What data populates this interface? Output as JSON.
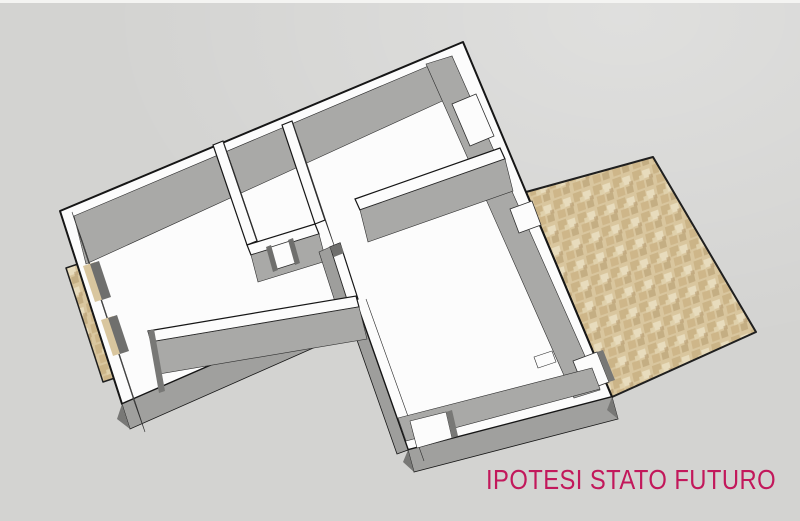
{
  "title": {
    "label": "IPOTESI STATO FUTURO",
    "color": "#c2185b"
  },
  "scene": {
    "description": "3D axonometric SketchUp-style render of an apartment floor plan hypothesis (future state)",
    "elements": {
      "floor_plan": "L-shaped apartment with white-topped walls and gray inner wall faces, door and window openings",
      "terrace_right": "large tiled terrace attached to the right side of the apartment",
      "balcony_left": "narrow tiled balcony strip attached to the left exterior wall"
    }
  },
  "colors": {
    "background": "#d3d3d1",
    "wall-top": "#fcfcfc",
    "wall-face": "#a9a9a7",
    "wall-face-shadow": "#8c8c8a",
    "wall-face-dark": "#787876",
    "door-reveal": "#6f6f6d",
    "outline": "#1a1a1a",
    "tile-base": "#d9c69e",
    "tile-dark": "#c9b183",
    "tile-light": "#e8dcbd",
    "text-accent": "#c2185b"
  }
}
